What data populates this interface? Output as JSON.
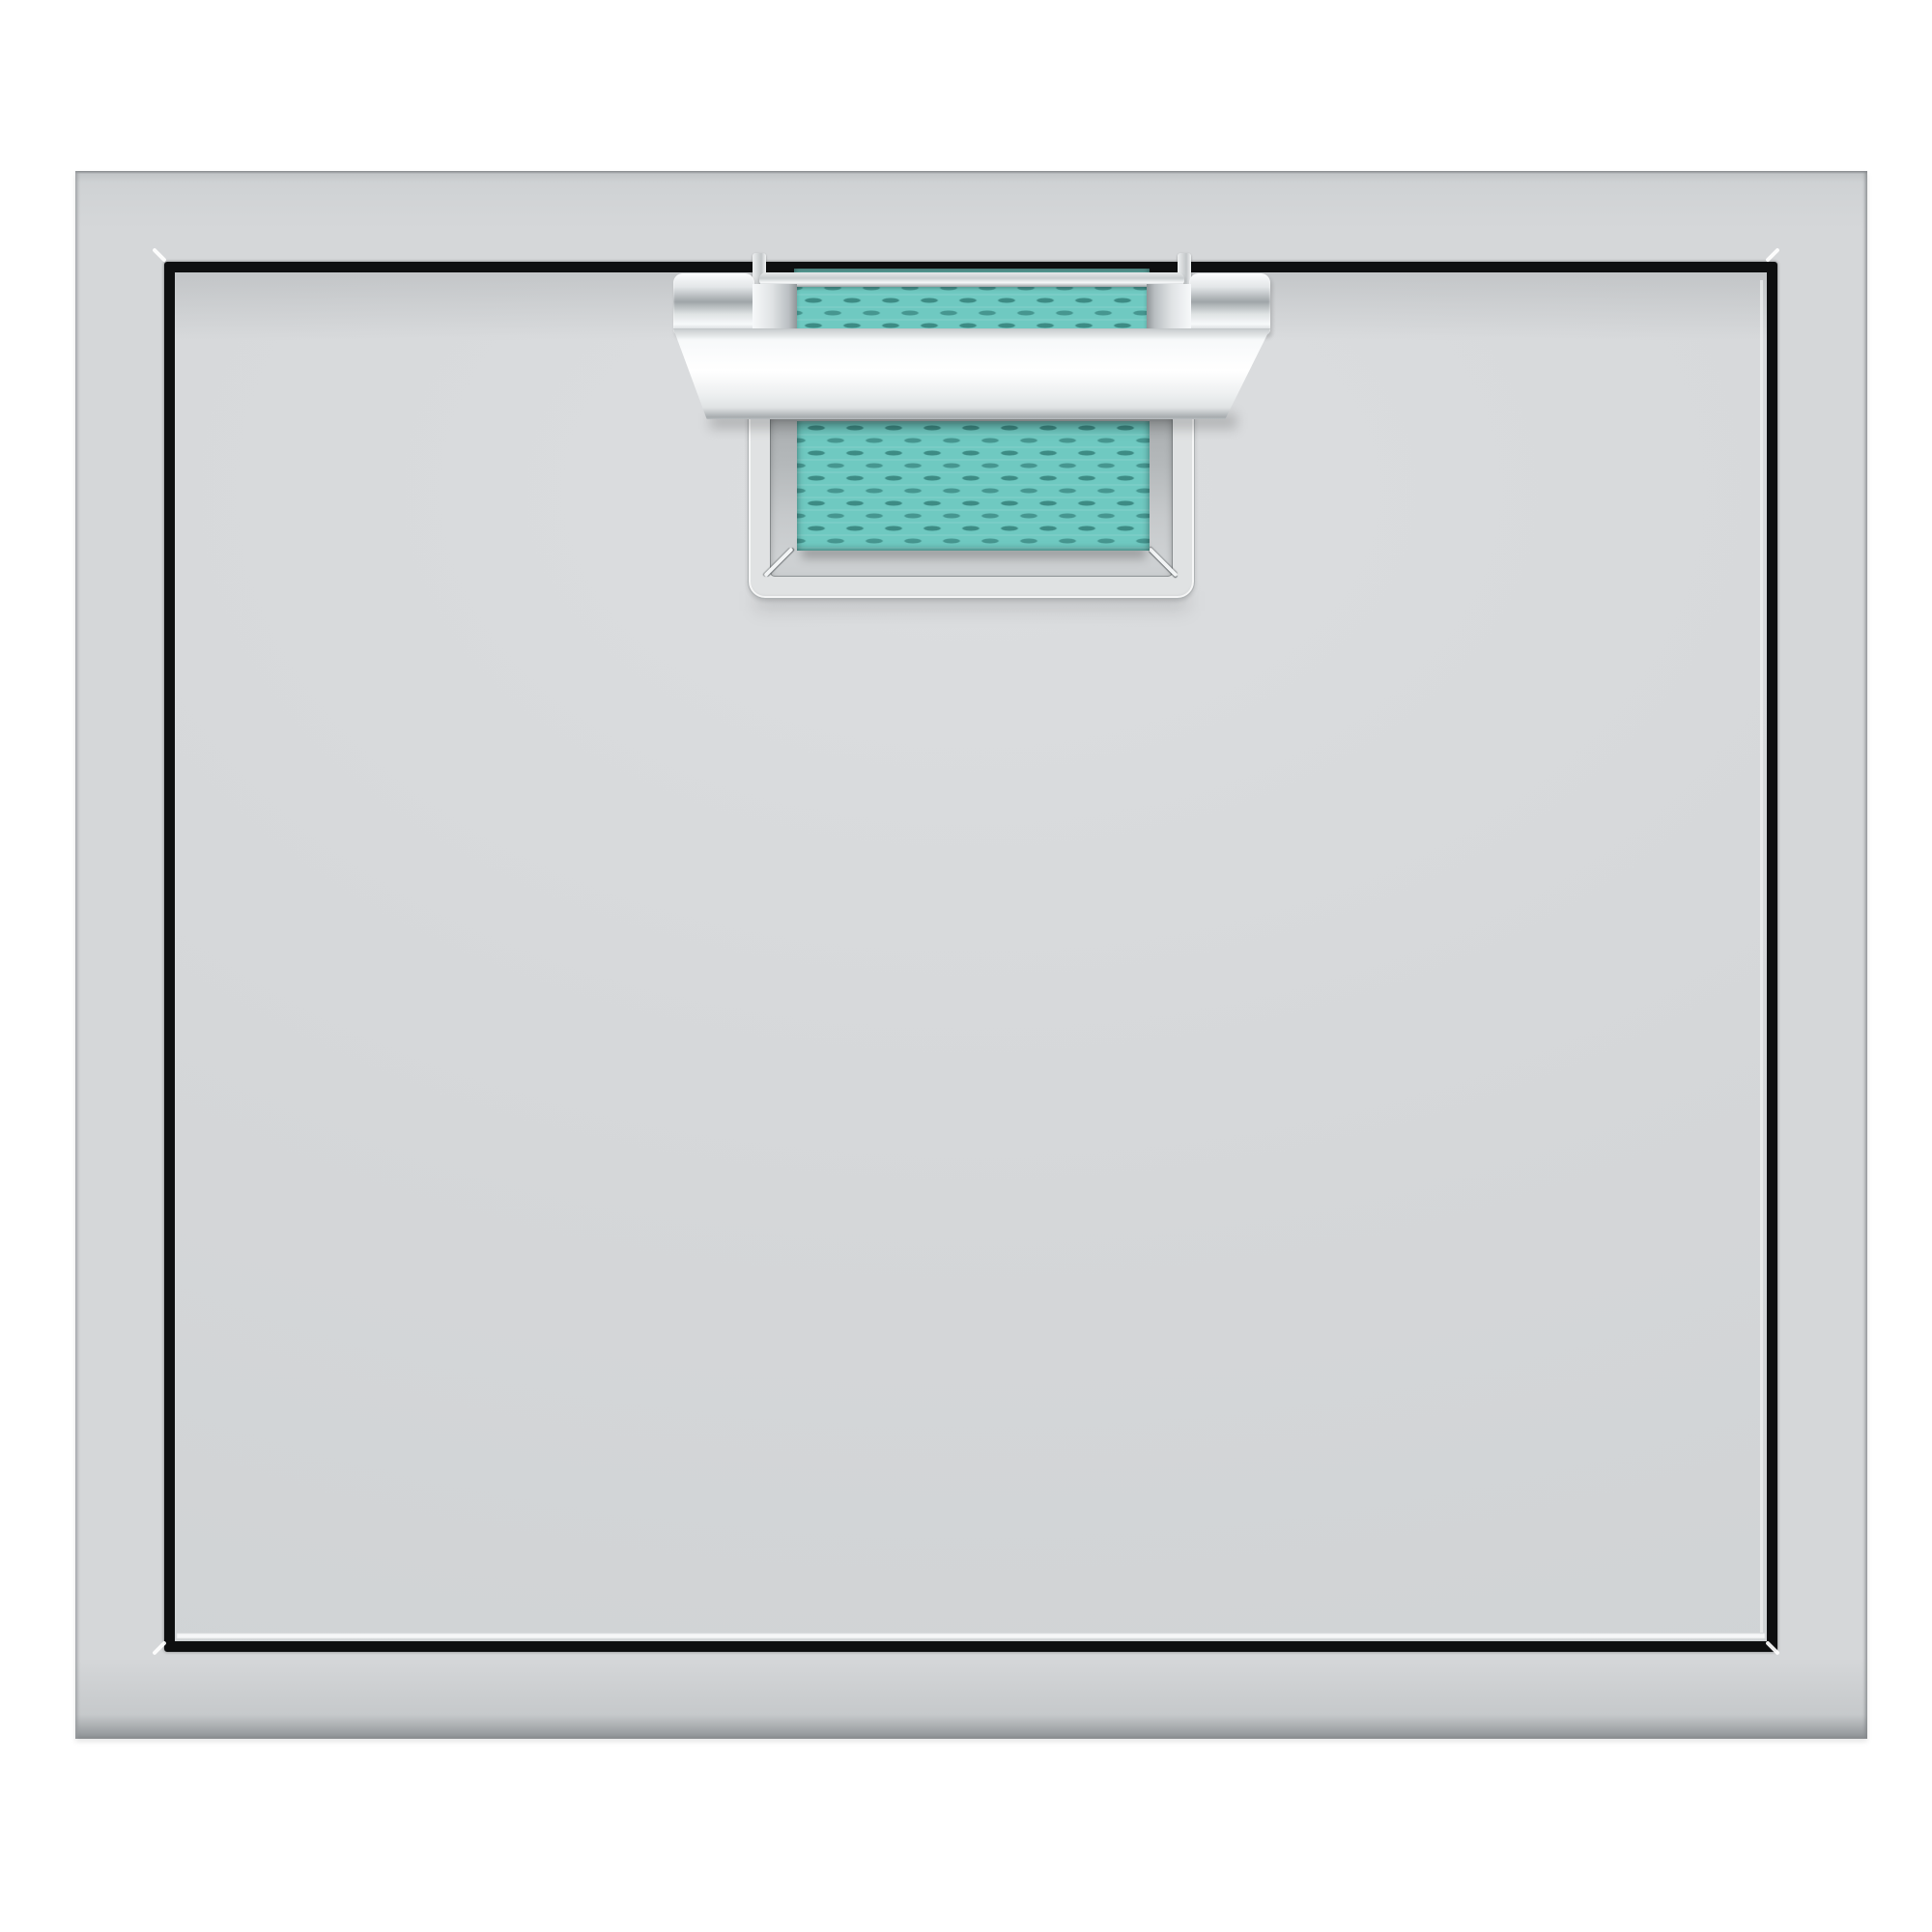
{
  "meta": {
    "description": "Product render of a single-door stainless steel access door with a chrome commercial-grade handle and a turquoise woven strap accent, mounted in a square outer frame on a white background."
  },
  "colors": {
    "background": "#ffffff",
    "panel_face": "#d5d7d9",
    "panel_face_light": "#dcdee0",
    "panel_edge_dark": "#84888b",
    "reveal_black": "#0e0f10",
    "chrome_white": "#f7f9fa",
    "chrome_mid": "#b9bec1",
    "chrome_dark": "#9fa5a8",
    "accent_teal": "#6fc9c1",
    "accent_teal_deep": "#2f7a74",
    "recess_wall": "#a9adaf",
    "recess_floor": "#ced1d3",
    "rim_face": "#e0e2e3"
  },
  "components": {
    "product": {
      "label": "Access door product image"
    },
    "frame": {
      "label": "Stainless steel outer frame"
    },
    "reveal": {
      "label": "Door reveal gap"
    },
    "door": {
      "label": "Door panel"
    },
    "handle": {
      "label": "Chrome handle bracket"
    },
    "strap_upper": {
      "label": "Turquoise woven strap, upper segment"
    },
    "strap_lower": {
      "label": "Turquoise woven strap, lower segment"
    },
    "pocket": {
      "label": "Recessed handle pocket"
    },
    "hook": {
      "label": "Handle mounting hook"
    }
  }
}
